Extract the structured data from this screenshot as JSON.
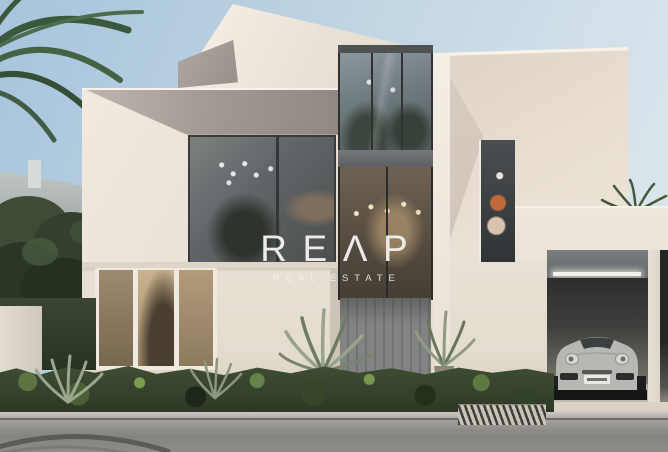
{
  "scene": {
    "alt": "Modern white geometric two-storey villa render with floor-to-ceiling glazing, warm interior lighting, palm trees, a low green hedge, a grey road in front and a silver sports car parked in an open garage on the right",
    "objects": [
      "villa",
      "palm trees",
      "background trees",
      "entry tower glazing",
      "entry door",
      "living room windows",
      "potted agave plants",
      "hedge",
      "drain grate",
      "road",
      "garage",
      "garage led strip",
      "silver sports car",
      "license plate"
    ]
  },
  "watermark": {
    "logo_text": "REΛP",
    "subtitle": "REAL ESTATE"
  },
  "colors": {
    "sky_top": "#a6c4dc",
    "sky_bottom": "#e0e8ed",
    "wall_cream": "#e9e0d4",
    "wall_cream_light": "#f5eee4",
    "wall_shadow": "#8e8780",
    "glass_dark": "#4b4e4c",
    "warm_light": "#caa97b",
    "hedge_green": "#3f4d34",
    "road_gray": "#9a9895",
    "car_silver": "#b6b8b4",
    "watermark_white": "#f5f4f2"
  }
}
